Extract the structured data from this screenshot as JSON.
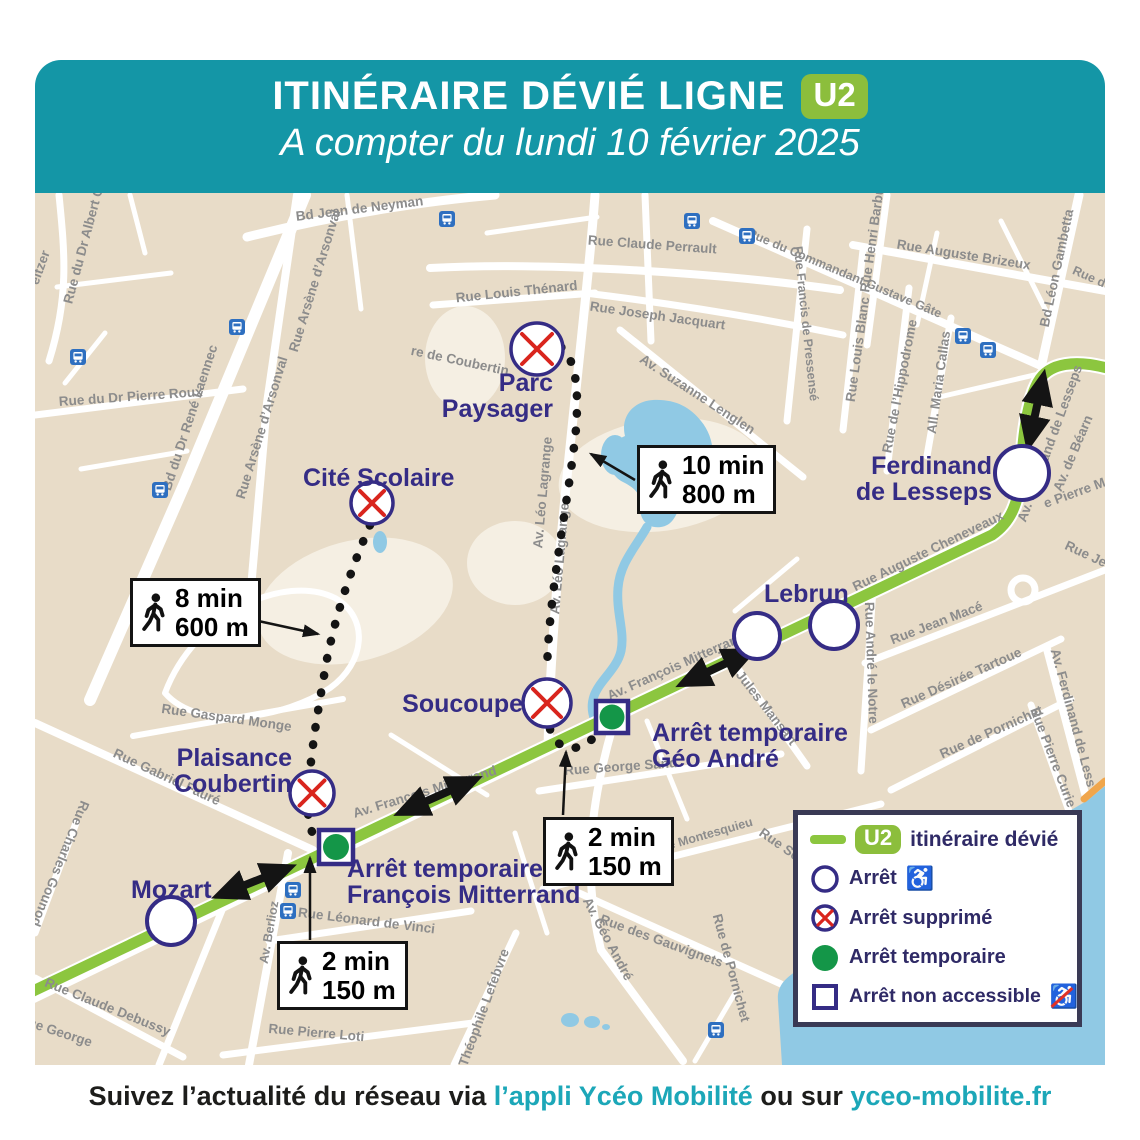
{
  "header": {
    "title": "ITINÉRAIRE DÉVIÉ LIGNE",
    "line_badge": "U2",
    "subtitle": "A compter du lundi 10 février 2025"
  },
  "footer": {
    "prefix": "Suivez l’actualité du réseau via ",
    "app_link": "l’appli Ycéo Mobilité",
    "middle": " ou sur ",
    "site_link": "yceo-mobilite.fr"
  },
  "legend": {
    "route_badge": "U2",
    "route_label": "itinéraire dévié",
    "stop_label": "Arrêt",
    "wheelchair_icon": "♿",
    "removed_label": "Arrêt supprimé",
    "temporary_label": "Arrêt temporaire",
    "not_accessible_label": "Arrêt non accessible"
  },
  "stops": {
    "mozart": "Mozart",
    "cite_scolaire": "Cité Scolaire",
    "parc_paysager": {
      "line1": "Parc",
      "line2": "Paysager"
    },
    "plaisance": {
      "line1": "Plaisance",
      "line2": "Coubertin"
    },
    "soucoupe": "Soucoupe",
    "lebrun": "Lebrun",
    "ferdinand": {
      "line1": "Ferdinand",
      "line2": "de Lesseps"
    },
    "temp_mitterrand": {
      "line1": "Arrêt temporaire",
      "line2": "François Mitterrand"
    },
    "temp_geo_andre": {
      "line1": "Arrêt temporaire",
      "line2": "Géo André"
    }
  },
  "callouts": {
    "walk8": {
      "time": "8 min",
      "dist": "600 m"
    },
    "walk10": {
      "time": "10 min",
      "dist": "800 m"
    },
    "walk2_fm": {
      "time": "2 min",
      "dist": "150 m"
    },
    "walk2_geo": {
      "time": "2 min",
      "dist": "150 m"
    }
  },
  "streets": [
    "Bd Jean de Neyman",
    "Rue Claude Perrault",
    "Rue Louis Thénard",
    "Rue Joseph Jacquart",
    "Av. Suzanne Lenglen",
    "Rue du Commandant Gustave Gâte",
    "Rue Francis de Pressensé",
    "Rue Auguste Brizeux",
    "Bd Léon Gambetta",
    "Rue du",
    "Rue Henri Barbusse",
    "Rue Louis Blanc",
    "Rue de l’Hippodrome",
    "All. Maria Callas",
    "Av. Ferdinand de Lesseps",
    "Av. de Béarn",
    "e Pierre M",
    "Rue Auguste Cheneveaux",
    "Rue Jean Macé",
    "Rue André le Notre",
    "Rue Désirée Tartoue",
    "Rue de Pornichet",
    "Rue de Pornichet",
    "Av. Ferdinand de Less",
    "Rue Pierre Curie",
    "Rue Jules Mansart",
    "Av. François Mitterrand",
    "Av. François Mitterrand",
    "Rue George Sand",
    "Rue Charles de Montesquieu",
    "Rue des Gauvignets",
    "Av. Géo André",
    "Théophile Lefebvre",
    "Rue Léonard de Vinci",
    "Rue Pierre Loti",
    "Av. Berlioz",
    "Rue Charles Gounod",
    "Rue Claude Debussy",
    "Rue George",
    "Rue Gabriel Fauré",
    "Rue Gaspard Monge",
    "Rue du Dr Pierre Roux",
    "Bd du Dr René Laennec",
    "Rue Arsène d’Arsonval",
    "Rue Arsène d’Arsonval",
    "Rue du Dr Albert Cal",
    "eitzer",
    "Av. Léo Lagrange",
    "Av. Léo Lagrange",
    "re de Coubertin",
    "Rue Sév",
    "Rue Je"
  ],
  "colors": {
    "header_teal": "#1496A6",
    "line_green": "#8CC63F",
    "badge_green": "#8CBE3C",
    "navy": "#352C85",
    "removed_red": "#D9251D",
    "temporary_green": "#149648",
    "water_blue": "#90C9E4",
    "map_beige": "#E8DCC8",
    "link_teal": "#1CA7B8",
    "bus_icon_blue": "#2E6FC0"
  }
}
